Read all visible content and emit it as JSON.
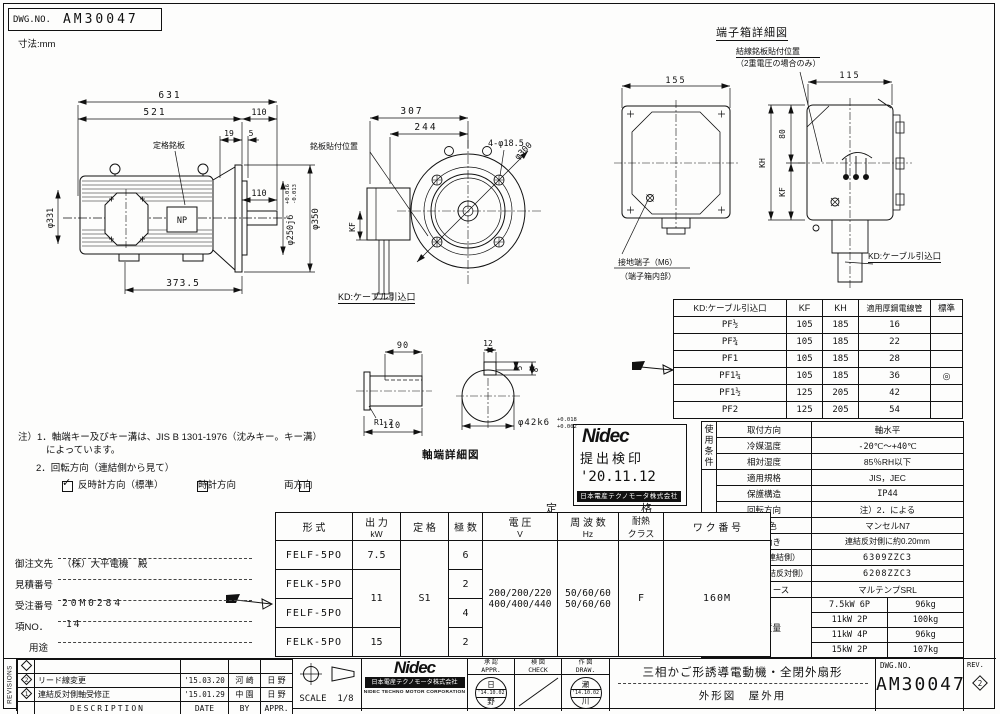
{
  "sheet": {
    "dwg_label": "DWG.NO.",
    "dwg_no": "AM30047",
    "units": "寸法:mm"
  },
  "side_view": {
    "d631": "631",
    "d521": "521",
    "d110_flange": "110",
    "d19": "19",
    "d5": "5",
    "d110_shaft": "110",
    "d373": "373.5",
    "dia_fan": "φ331",
    "dia_spigot": "φ250j6",
    "spigot_tol_u": "+0.016",
    "spigot_tol_l": "-0.013",
    "dia_flange": "φ350",
    "nameplate": "定格銘板",
    "np": "NP"
  },
  "front_view": {
    "d307": "307",
    "d244": "244",
    "holes": "4-φ18.5",
    "bc": "φ300",
    "kf": "KF",
    "plate_pos": "銘板貼付位置",
    "cable": "KD:ケーブル引込口"
  },
  "tbox": {
    "title": "端子箱詳細図",
    "d155": "155",
    "d115": "115",
    "d80": "80",
    "kh": "KH",
    "kf": "KF",
    "wire_plate1": "結線銘板貼付位置",
    "wire_plate2": "（2重電圧の場合のみ）",
    "ground1": "接地端子（M6）",
    "ground2": "（端子箱内部）",
    "cable": "KD:ケーブル引込口"
  },
  "shaft": {
    "title": "軸端詳細図",
    "d90": "90",
    "r12": "R1.2",
    "d110": "110",
    "d12": "12",
    "d5": "5",
    "d8": "8",
    "dia": "φ42k6",
    "tol_u": "+0.018",
    "tol_l": "+0.002"
  },
  "kd_table": {
    "headers": [
      "KD:ケーブル引込口",
      "KF",
      "KH",
      "適用厚鋼電線管",
      "標準"
    ],
    "rows": [
      [
        "PF½",
        "105",
        "185",
        "16",
        ""
      ],
      [
        "PF¾",
        "105",
        "185",
        "22",
        ""
      ],
      [
        "PF1",
        "105",
        "185",
        "28",
        ""
      ],
      [
        "PF1¼",
        "105",
        "185",
        "36",
        "◎"
      ],
      [
        "PF1½",
        "125",
        "205",
        "42",
        ""
      ],
      [
        "PF2",
        "125",
        "205",
        "54",
        ""
      ]
    ]
  },
  "notes": {
    "l1": "注）1．軸端キー及びキー溝は、JIS B 1301-1976（沈みキー。キー溝）",
    "l2": "によっています。",
    "l3": "2．回転方向（連結側から見て）",
    "cb1": "反時計方向（標準）",
    "cb2": "時計方向",
    "cb3": "両方向",
    "check": "✓"
  },
  "inspection_stamp": {
    "logo": "Nidec",
    "title": "提出検印",
    "date": "'20.11.12",
    "company": "日本電産テクノモータ株式会社"
  },
  "order": {
    "customer_label": "御注文先",
    "customer": "（株）大平電機　殿",
    "quote_label": "見積番号",
    "quote": "",
    "order_label": "受注番号",
    "order_no": "20M0284",
    "item_label": "項NO．",
    "item": "14",
    "use_label": "用途",
    "use": ""
  },
  "main_table": {
    "group": "定格",
    "h_model": "形 式",
    "h_output": "出 力",
    "h_output_u": "kW",
    "h_duty": "定 格",
    "h_poles": "極 数",
    "h_volt": "電 圧",
    "h_volt_u": "V",
    "h_freq": "周 波 数",
    "h_freq_u": "Hz",
    "h_heat1": "耐熱",
    "h_heat2": "クラス",
    "h_frame": "ワ ク 番 号",
    "m1": "FELF-5PO",
    "m2": "FELK-5PO",
    "m3": "FELF-5PO",
    "m4": "FELK-5PO",
    "out1": "7.5",
    "out23": "11",
    "out4": "15",
    "duty": "S1",
    "p1": "6",
    "p2": "2",
    "p3": "4",
    "p4": "2",
    "v1": "200/200/220",
    "v2": "400/400/440",
    "f1": "50/60/60",
    "f2": "50/60/60",
    "heat": "F",
    "frame": "160M"
  },
  "spec_table": {
    "g1": "使用条件",
    "g2": "設計仕様",
    "rows": [
      [
        "取付方向",
        "軸水平"
      ],
      [
        "冷媒温度",
        "-20℃～+40℃"
      ],
      [
        "相対湿度",
        "85％RH以下"
      ],
      [
        "適用規格",
        "JIS，JEC"
      ],
      [
        "保護構造",
        "IP44"
      ],
      [
        "回転方向",
        "注）2．による"
      ],
      [
        "塗装色",
        "マンセルN7"
      ],
      [
        "軸の動き",
        "連結反対側に約0.20mm"
      ],
      [
        "軸受番号（連結側）",
        "6309ZZC3"
      ],
      [
        "（連結反対側）",
        "6208ZZC3"
      ],
      [
        "軸受グリース",
        "マルテンプSRL"
      ]
    ],
    "weight_label": "概算質量",
    "weights": [
      [
        "7.5kW 6P",
        "96kg"
      ],
      [
        "11kW 2P",
        "100kg"
      ],
      [
        "11kW 4P",
        "96kg"
      ],
      [
        "15kW 2P",
        "107kg"
      ]
    ]
  },
  "title_block": {
    "revisions": "REVISIONS",
    "rev_rows": [
      {
        "mark": "",
        "desc": "",
        "date": "",
        "by": "",
        "appr": ""
      },
      {
        "mark": "2",
        "desc": "リード線変更",
        "date": "'15.03.20",
        "by": "河 崎",
        "appr": "日 野"
      },
      {
        "mark": "1",
        "desc": "連結反対側軸受修正",
        "date": "'15.01.29",
        "by": "中 園",
        "appr": "日 野"
      }
    ],
    "f_desc": "DESCRIPTION",
    "f_date": "DATE",
    "f_by": "BY",
    "f_appr": "APPR.",
    "scale_label": "SCALE",
    "scale": "1/8",
    "nidec_logo": "Nidec",
    "nidec_jp": "日本電産テクノモータ株式会社",
    "nidec_en": "NIDEC TECHNO MOTOR CORPORATION",
    "appr_jp": "承 認",
    "appr_en": "APPR.",
    "check_jp": "検 図",
    "check_en": "CHECK",
    "draw_jp": "作 図",
    "draw_en": "DRAW.",
    "appr_stamp_top": "日",
    "appr_stamp_date": "'14.10.02",
    "appr_stamp_bot": "野",
    "draw_stamp_top": "瀬",
    "draw_stamp_date": "'14.10.02",
    "draw_stamp_bot": "川",
    "title1": "三相かご形誘導電動機・全閉外扇形",
    "title2": "外形図　屋外用",
    "dwg_label": "DWG.NO.",
    "dwg_no": "AM30047",
    "rev_label": "REV.",
    "rev_no": "2"
  }
}
